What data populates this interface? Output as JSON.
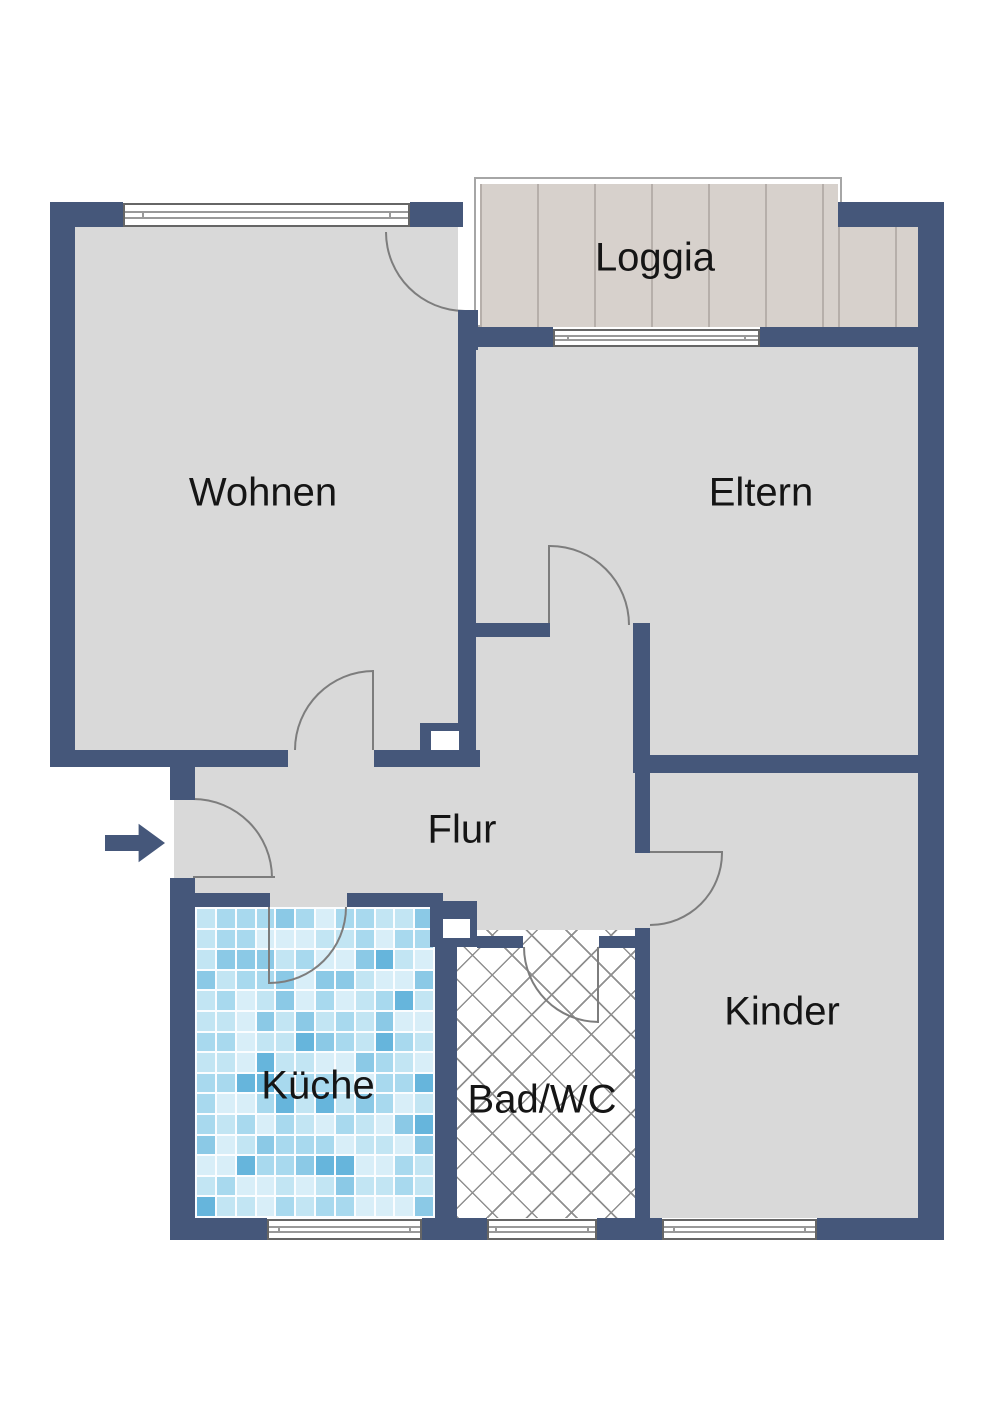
{
  "plan": {
    "type": "apartment-floor-plan",
    "rooms": {
      "loggia": {
        "label": "Loggia"
      },
      "wohnen": {
        "label": "Wohnen"
      },
      "eltern": {
        "label": "Eltern"
      },
      "flur": {
        "label": "Flur"
      },
      "kueche": {
        "label": "Küche"
      },
      "bad": {
        "label": "Bad/WC"
      },
      "kinder": {
        "label": "Kinder"
      }
    },
    "entrance": {
      "symbol": "arrow-right"
    }
  },
  "colors": {
    "wall": "#45577a",
    "floor": "#d9d9d9",
    "outline_gray": "#a6a6a6",
    "door_line": "#7d7d7d",
    "wood_base": "#d7d1cc",
    "wood_line": "#b6afaa",
    "hatch_line": "#8f8f8f",
    "tile_grout": "#fbfdff",
    "tile_palette": [
      "#d8eef8",
      "#c2e5f3",
      "#a8d9ee",
      "#8bc9e6",
      "#66b5dc"
    ]
  },
  "kitchen_tiles": {
    "cols": 12,
    "rows": 15,
    "weights": [
      0.28,
      0.24,
      0.2,
      0.16,
      0.12
    ],
    "seed": 11
  }
}
